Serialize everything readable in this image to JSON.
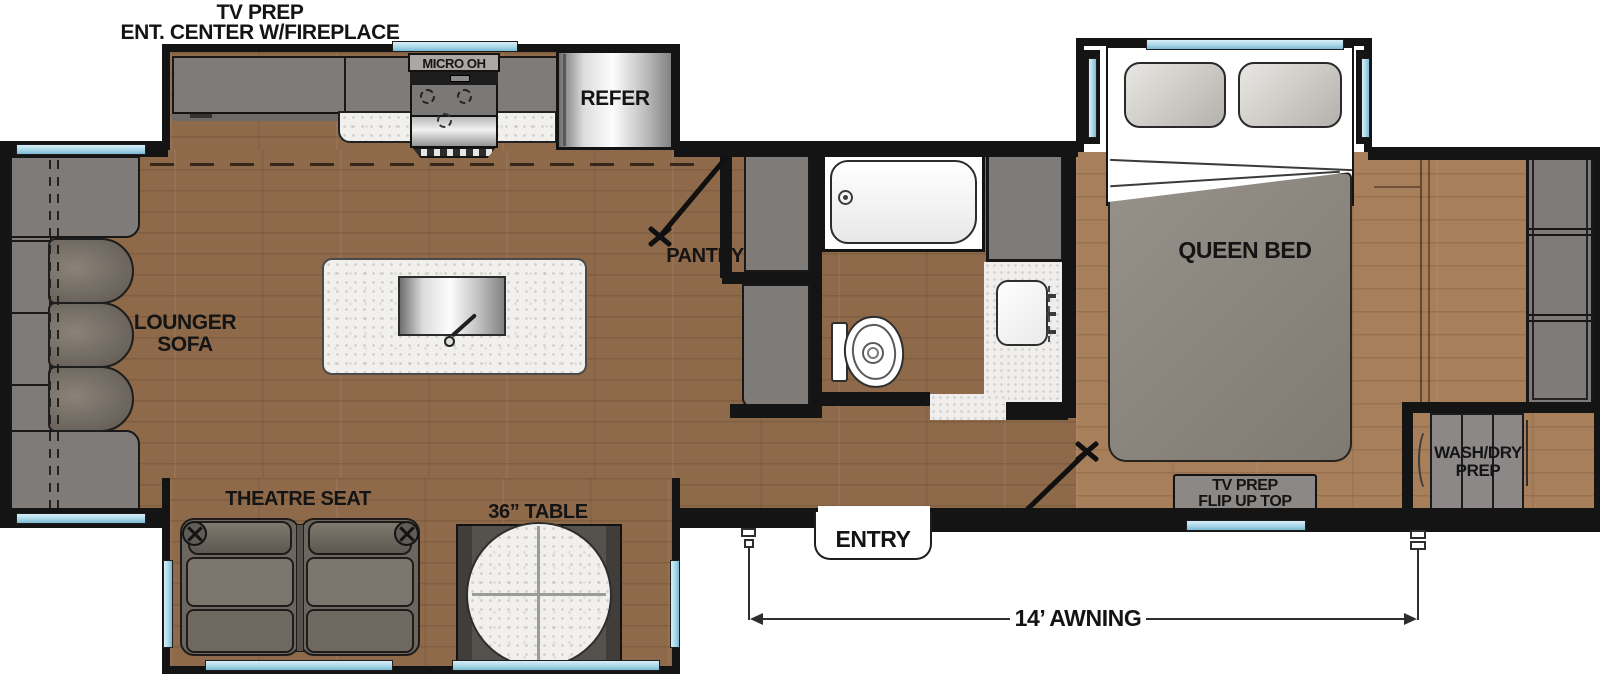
{
  "labels": {
    "ent_center_line1": "TV PREP",
    "ent_center_line2": "ENT. CENTER W/FIREPLACE",
    "micro_oh": "MICRO OH",
    "refrigerator": "REFER",
    "pantry": "PANTRY",
    "queen_bed": "QUEEN BED",
    "lounger_line1": "LOUNGER",
    "lounger_line2": "SOFA",
    "theatre_seat": "THEATRE SEAT",
    "table_36": "36” TABLE",
    "entry": "ENTRY",
    "tv_prep_flip_line1": "TV PREP",
    "tv_prep_flip_line2": "FLIP UP TOP",
    "wash_dry_line1": "WASH/DRY",
    "wash_dry_line2": "PREP",
    "awning_14": "14’ AWNING"
  },
  "colors": {
    "wall": "#141414",
    "floor_main": "#8e6a4a",
    "floor_bedroom": "#a87f5b",
    "cabinet_gray": "#7e7b79",
    "cabinet_dark": "#58534f",
    "window_glass": "#a9d7e8",
    "counter_white": "#f1f0ed",
    "upholstery": "#6c6660",
    "upholstery_light": "#7d766e",
    "bed_blanket": "#8f8a81"
  }
}
